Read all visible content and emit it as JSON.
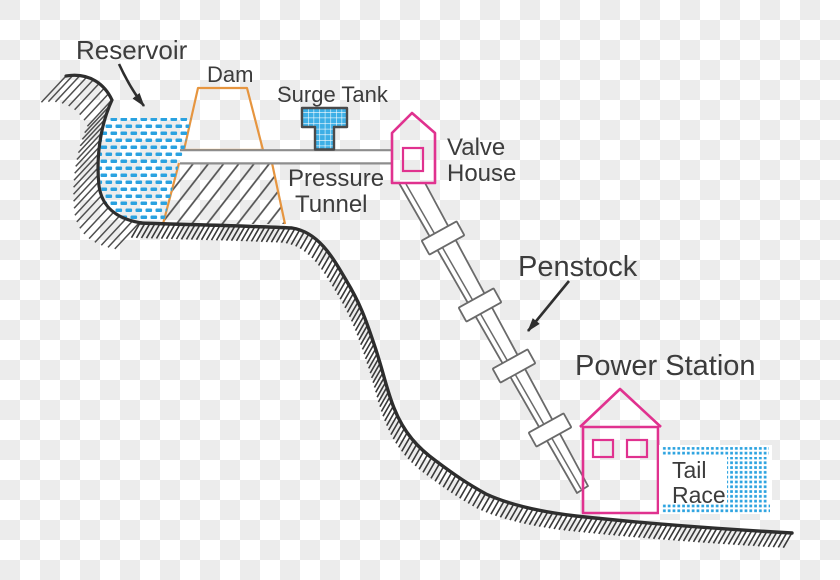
{
  "labels": {
    "reservoir": "Reservoir",
    "dam": "Dam",
    "surge_tank": "Surge Tank",
    "pressure_tunnel_line1": "Pressure",
    "pressure_tunnel_line2": "Tunnel",
    "valve_house_line1": "Valve",
    "valve_house_line2": "House",
    "penstock": "Penstock",
    "power_station": "Power Station",
    "tail_race_line1": "Tail",
    "tail_race_line2": "Race"
  },
  "colors": {
    "water_blue": "#2aa2e0",
    "surge_tank_blue": "#3dafe6",
    "building_pink": "#e0328f",
    "dam_outline_orange": "#e6953f",
    "ground_dark": "#2e2e2e",
    "hatch_gray": "#4f4f4f",
    "pipe_gray": "#6a6a6a",
    "tunnel_gray": "#8d8d8d",
    "label_text": "#3c3c3c",
    "checker_gray": "#ececec"
  }
}
